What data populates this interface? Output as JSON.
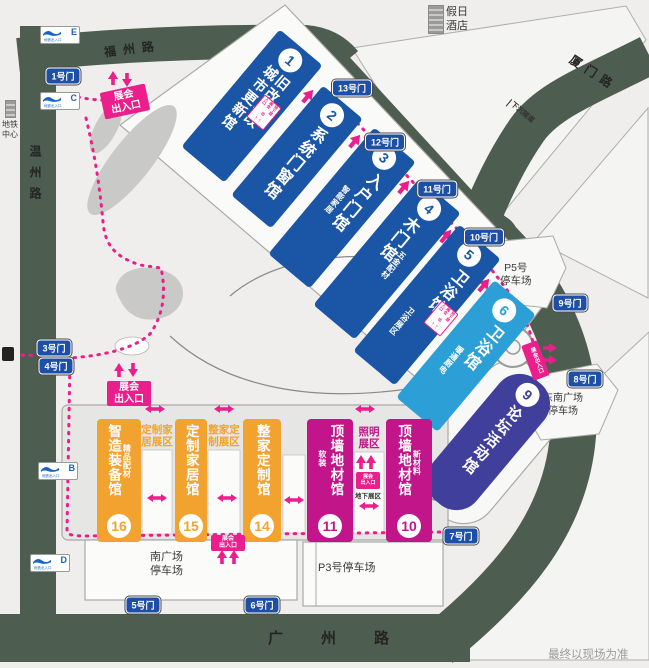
{
  "roads": {
    "north": "福州路",
    "west": "温州路",
    "east": "厦门路",
    "south": "广州路",
    "tunnel": "下沉隧道"
  },
  "landmarks": {
    "hotel": {
      "line1": "假日",
      "line2": "酒店"
    },
    "metro_center": {
      "line1": "地铁",
      "line2": "中心"
    },
    "disclaimer": "最终以现场为准"
  },
  "parking": {
    "p5": {
      "line1": "P5号",
      "line2": "停车场"
    },
    "southeast": {
      "line1": "东南广场",
      "line2": "停车场"
    },
    "south": {
      "line1": "南广场",
      "line2": "停车场"
    },
    "p3": "P3号停车场"
  },
  "gates": {
    "g1": "1号门",
    "g3": "3号门",
    "g4": "4号门",
    "g5": "5号门",
    "g6": "6号门",
    "g7": "7号门",
    "g8": "8号门",
    "g9": "9号门",
    "g10": "10号门",
    "g11": "11号门",
    "g12": "12号门",
    "g13": "13号门"
  },
  "metro_exits": {
    "label": "地铁出入口",
    "e": "E",
    "c": "C",
    "b": "B",
    "d": "D"
  },
  "entrances": {
    "main": {
      "line1": "展会",
      "line2": "出入口"
    },
    "basement_mini": {
      "line1": "地下层",
      "line2": "展会",
      "line3": "出入口"
    },
    "basement_zone": "地下展区",
    "up_arrow": "↑",
    "down_arrow": "↓"
  },
  "halls": {
    "h1": {
      "num": "1",
      "name1": "旧改局改",
      "name2": "城市更新馆"
    },
    "h2": {
      "num": "2",
      "name": "系统门窗馆"
    },
    "h3": {
      "num": "3",
      "name": "入户门馆",
      "side": "智能家居"
    },
    "h4": {
      "num": "4",
      "name": "木门馆",
      "side": "五金配材"
    },
    "h5": {
      "num": "5",
      "name": "卫浴馆",
      "side": "卫浴展区"
    },
    "h6": {
      "num": "6",
      "name": "卫浴馆",
      "side": "暖通厨电"
    },
    "h9": {
      "num": "9",
      "name": "论坛活动馆"
    },
    "h10": {
      "num": "10",
      "name": "顶墙地材馆",
      "side": "新材料"
    },
    "h11": {
      "num": "11",
      "name": "顶墙地材馆",
      "side": "软装"
    },
    "h14": {
      "num": "14",
      "name": "整家定制馆"
    },
    "h15": {
      "num": "15",
      "name": "定制家居馆"
    },
    "h16": {
      "num": "16",
      "name": "智造装备馆",
      "side": "精品配材"
    }
  },
  "zones": {
    "custom_home": {
      "line1": "定制家",
      "line2": "居展区"
    },
    "whole_home": {
      "line1": "整家定",
      "line2": "制展区"
    },
    "lighting": {
      "line1": "照明",
      "line2": "展区"
    }
  },
  "colors": {
    "hall_blue": "#1a56a5",
    "hall_lightblue": "#2b9fd6",
    "hall_indigo": "#413f9c",
    "hall_magenta": "#c3158a",
    "hall_orange": "#f2a32f",
    "accent_pink": "#ec1e8c",
    "road_green": "#4d5d4f",
    "gate_blue": "#1d4fa6"
  }
}
